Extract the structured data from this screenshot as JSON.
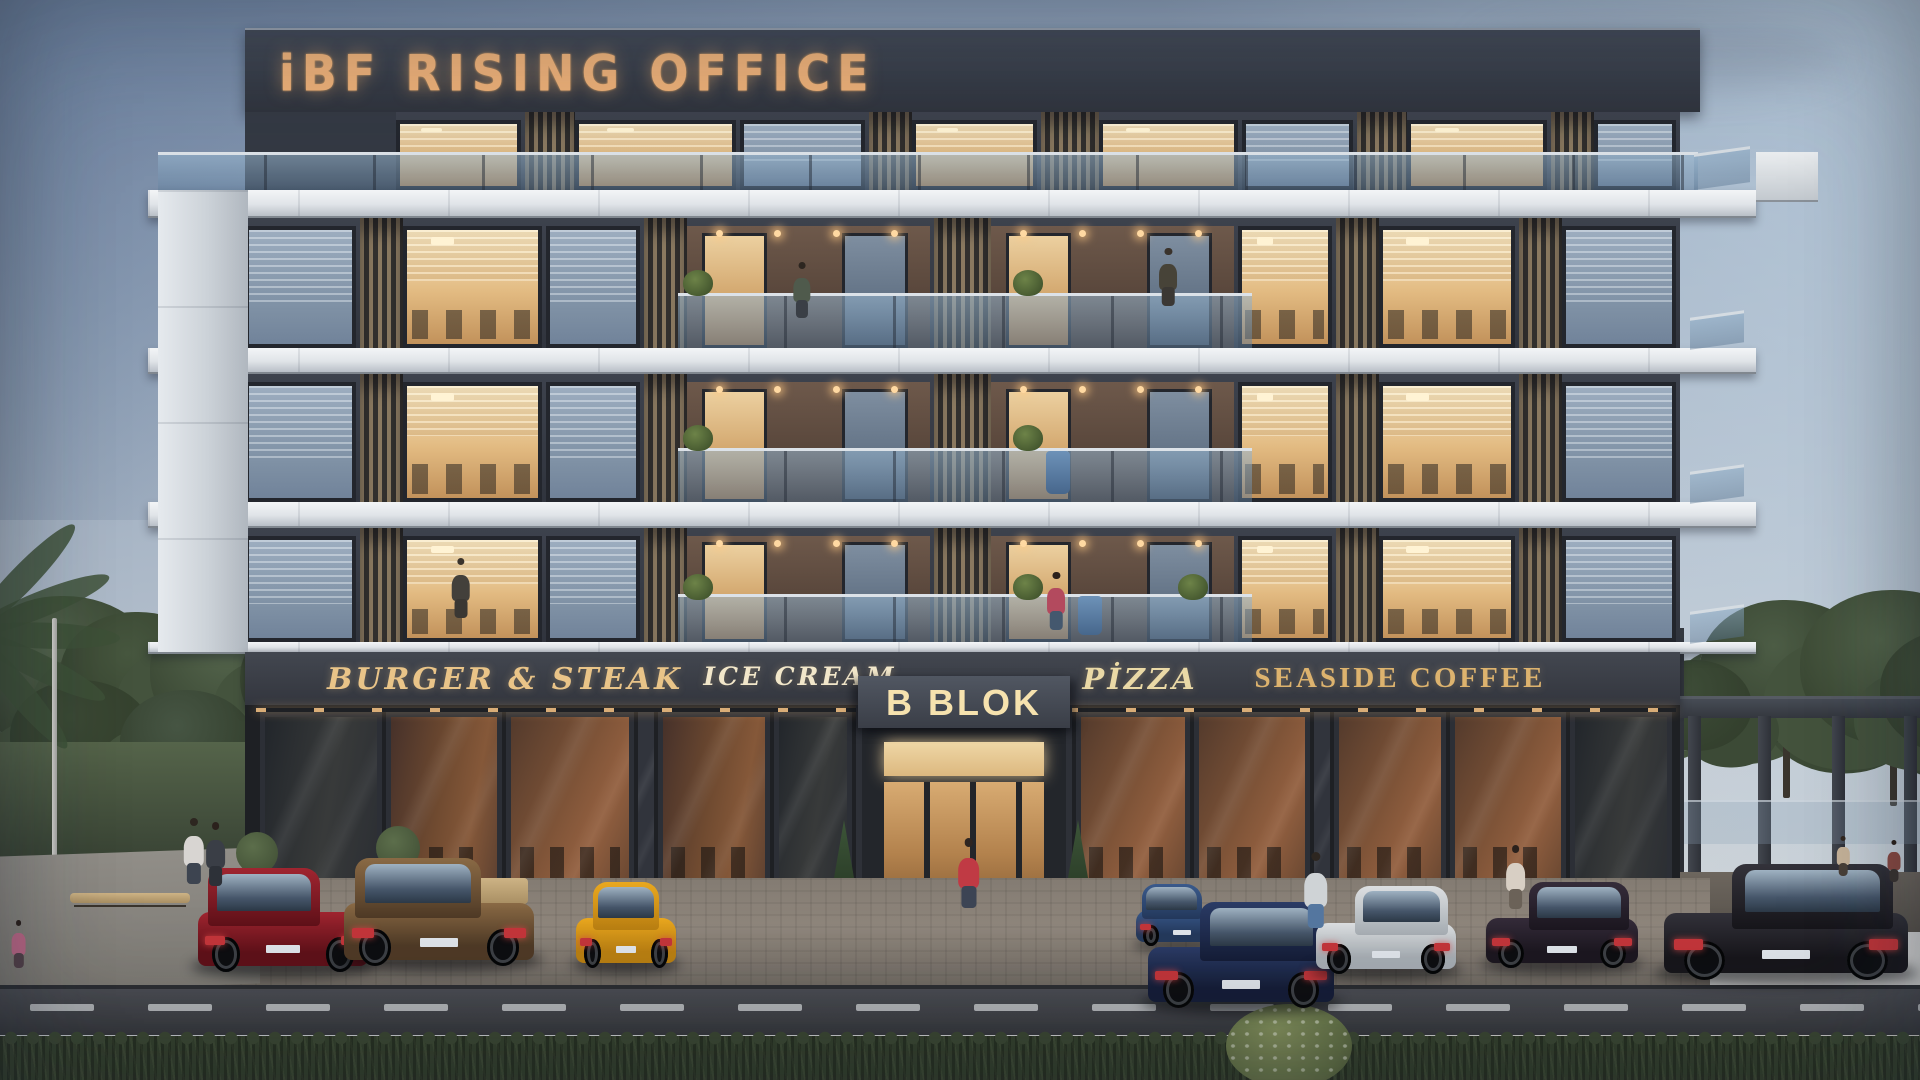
{
  "signs": {
    "rooftop": "iBF RISING OFFICE",
    "entrance_label": "B BLOK",
    "shops": [
      {
        "label": "BURGER & STEAK",
        "x": 505,
        "color": "#e9c488",
        "size": 30,
        "style": "script"
      },
      {
        "label": "ICE CREAM",
        "x": 800,
        "color": "#f2e7ca",
        "size": 25,
        "style": "script"
      },
      {
        "label": "PİZZA",
        "x": 1140,
        "color": "#ead9a6",
        "size": 29,
        "style": "script"
      },
      {
        "label": "SEASIDE COFFEE",
        "x": 1400,
        "color": "#ddb36e",
        "size": 29,
        "style": "serif"
      }
    ]
  },
  "palette": {
    "facade_dark": "#3d424d",
    "band_white": "#e8ecef",
    "sign_gold": "#edb077",
    "window_lit": "#e2ba81",
    "window_dusk": "#8fa3b8",
    "rail_glass": "#9ab6cf",
    "hedge_green": "#36432f",
    "road_gray": "#44464c"
  },
  "building": {
    "floors": [
      {
        "y": 218,
        "h": 130
      },
      {
        "y": 374,
        "h": 128
      },
      {
        "y": 528,
        "h": 114
      }
    ],
    "facade_x": 245,
    "facade_w": 1435,
    "pattern": [
      {
        "t": "dim",
        "x": 0.0,
        "w": 0.08
      },
      {
        "t": "slat",
        "x": 0.08,
        "w": 0.03
      },
      {
        "t": "lit",
        "x": 0.11,
        "w": 0.1,
        "desks": true
      },
      {
        "t": "dim",
        "x": 0.21,
        "w": 0.068
      },
      {
        "t": "slat",
        "x": 0.278,
        "w": 0.03
      },
      {
        "t": "balc",
        "x": 0.308,
        "w": 0.172
      },
      {
        "t": "slat",
        "x": 0.48,
        "w": 0.04
      },
      {
        "t": "balc",
        "x": 0.52,
        "w": 0.172
      },
      {
        "t": "lit",
        "x": 0.692,
        "w": 0.068,
        "desks": true
      },
      {
        "t": "slat",
        "x": 0.76,
        "w": 0.03
      },
      {
        "t": "lit",
        "x": 0.79,
        "w": 0.098,
        "desks": true
      },
      {
        "t": "slat",
        "x": 0.888,
        "w": 0.03
      },
      {
        "t": "dim",
        "x": 0.918,
        "w": 0.082
      }
    ],
    "rails": [
      {
        "x": 0.302,
        "w": 0.4
      }
    ],
    "penthouse": {
      "y": 112,
      "h": 78,
      "x": 245,
      "w": 1435,
      "pattern": [
        {
          "t": "wall",
          "x": 0.0,
          "w": 0.105
        },
        {
          "t": "lit",
          "x": 0.105,
          "w": 0.09
        },
        {
          "t": "slat",
          "x": 0.195,
          "w": 0.035
        },
        {
          "t": "lit",
          "x": 0.23,
          "w": 0.115
        },
        {
          "t": "dim",
          "x": 0.345,
          "w": 0.09
        },
        {
          "t": "slat",
          "x": 0.435,
          "w": 0.03
        },
        {
          "t": "lit",
          "x": 0.465,
          "w": 0.09
        },
        {
          "t": "slat",
          "x": 0.555,
          "w": 0.04
        },
        {
          "t": "lit",
          "x": 0.595,
          "w": 0.1
        },
        {
          "t": "dim",
          "x": 0.695,
          "w": 0.08
        },
        {
          "t": "slat",
          "x": 0.775,
          "w": 0.035
        },
        {
          "t": "lit",
          "x": 0.81,
          "w": 0.1
        },
        {
          "t": "slat",
          "x": 0.91,
          "w": 0.03
        },
        {
          "t": "dim",
          "x": 0.94,
          "w": 0.06
        }
      ]
    },
    "plants": [
      {
        "floor": 0,
        "xf": 0.315
      },
      {
        "floor": 0,
        "xf": 0.545
      },
      {
        "floor": 1,
        "xf": 0.315
      },
      {
        "floor": 1,
        "xf": 0.545
      },
      {
        "floor": 2,
        "xf": 0.315
      },
      {
        "floor": 2,
        "xf": 0.545
      },
      {
        "floor": 2,
        "xf": 0.66
      }
    ],
    "blue_planters": [
      {
        "floor": 1,
        "x": 1046
      },
      {
        "floor": 2,
        "x": 1078
      }
    ],
    "bands": [
      {
        "y": 190,
        "h": 28
      },
      {
        "y": 348,
        "h": 26
      },
      {
        "y": 502,
        "h": 26
      },
      {
        "y": 642,
        "h": 12
      }
    ]
  },
  "storefront": {
    "panels": [
      {
        "x": 260,
        "w": 122,
        "tone": "dark"
      },
      {
        "x": 386,
        "w": 116,
        "tone": "warm"
      },
      {
        "x": 506,
        "w": 128,
        "tone": "warm2"
      },
      {
        "x": 638,
        "w": 16,
        "tone": "col"
      },
      {
        "x": 658,
        "w": 112,
        "tone": "warm"
      },
      {
        "x": 774,
        "w": 78,
        "tone": "dark"
      },
      {
        "x": 1076,
        "w": 114,
        "tone": "warm2"
      },
      {
        "x": 1194,
        "w": 116,
        "tone": "warm2"
      },
      {
        "x": 1314,
        "w": 16,
        "tone": "col"
      },
      {
        "x": 1334,
        "w": 112,
        "tone": "warm2"
      },
      {
        "x": 1450,
        "w": 116,
        "tone": "warm2"
      },
      {
        "x": 1570,
        "w": 102,
        "tone": "dark"
      }
    ]
  },
  "cars": [
    {
      "name": "car-red-sedan",
      "x": 198,
      "y": 868,
      "w": 170,
      "h": 104,
      "c1": "#a02530",
      "c2": "#5f1119",
      "cab": "#241d24",
      "facing": "left"
    },
    {
      "name": "car-bronze-sedan",
      "x": 344,
      "y": 858,
      "w": 190,
      "h": 108,
      "c1": "#8a6a45",
      "c2": "#4f3a26",
      "cab": "#241f1c",
      "facing": "left"
    },
    {
      "name": "car-yellow-mustang",
      "x": 576,
      "y": 882,
      "w": 100,
      "h": 86,
      "c1": "#eaa81f",
      "c2": "#b97f12",
      "cab": "#1e1c1a",
      "facing": "rear"
    },
    {
      "name": "car-blue-coupe",
      "x": 1136,
      "y": 884,
      "w": 92,
      "h": 62,
      "c1": "#3a5a8c",
      "c2": "#24395c",
      "cab": "#1a2230",
      "facing": "left"
    },
    {
      "name": "car-navy-golf",
      "x": 1148,
      "y": 902,
      "w": 186,
      "h": 106,
      "c1": "#2b3c66",
      "c2": "#151d38",
      "cab": "#10141f",
      "facing": "right"
    },
    {
      "name": "car-white-wagon",
      "x": 1316,
      "y": 886,
      "w": 140,
      "h": 88,
      "c1": "#dcdfe1",
      "c2": "#a6adb3",
      "cab": "#3a434e",
      "facing": "right"
    },
    {
      "name": "car-dark-sedan",
      "x": 1486,
      "y": 882,
      "w": 152,
      "h": 86,
      "c1": "#352c3a",
      "c2": "#1c1720",
      "cab": "#151019",
      "facing": "right"
    },
    {
      "name": "car-black-sedan",
      "x": 1664,
      "y": 864,
      "w": 244,
      "h": 116,
      "c1": "#33323a",
      "c2": "#17161b",
      "cab": "#0f0f13",
      "facing": "right"
    }
  ],
  "people": [
    {
      "name": "person-balcony-man",
      "x": 792,
      "y": 262,
      "h": 56,
      "head": "#2d2620",
      "body": "#4f5a4c",
      "legs": "#3a3f46"
    },
    {
      "name": "person-balcony-woman",
      "x": 1046,
      "y": 572,
      "h": 58,
      "head": "#2b211c",
      "body": "#b34a5e",
      "legs": "#44586e"
    },
    {
      "name": "person-office-figure-1",
      "x": 450,
      "y": 558,
      "h": 60,
      "head": "#3a332c",
      "body": "#43403b",
      "legs": "#3a3733"
    },
    {
      "name": "person-office-figure-2",
      "x": 1158,
      "y": 248,
      "h": 58,
      "head": "#3a332c",
      "body": "#474338",
      "legs": "#3b3834"
    },
    {
      "name": "person-walker-1",
      "x": 182,
      "y": 818,
      "h": 66,
      "head": "#2d2620",
      "body": "#d8d5d2",
      "legs": "#3d4450"
    },
    {
      "name": "person-walker-2",
      "x": 204,
      "y": 822,
      "h": 64,
      "head": "#2b211c",
      "body": "#3a3e46",
      "legs": "#2d3138"
    },
    {
      "name": "person-walker-pink",
      "x": 10,
      "y": 920,
      "h": 48,
      "head": "#2b211c",
      "body": "#c06a8a",
      "legs": "#55424a"
    },
    {
      "name": "person-sidewalk-man",
      "x": 1302,
      "y": 852,
      "h": 76,
      "head": "#2d2620",
      "body": "#cfd3d6",
      "legs": "#5577a0"
    },
    {
      "name": "person-sidewalk-woman",
      "x": 1504,
      "y": 845,
      "h": 64,
      "head": "#2b211c",
      "body": "#d8cfc4",
      "legs": "#6b6258"
    },
    {
      "name": "person-terrace-1",
      "x": 1836,
      "y": 836,
      "h": 40,
      "head": "#33291f",
      "body": "#c8b49a",
      "legs": "#4a4038"
    },
    {
      "name": "person-terrace-2",
      "x": 1886,
      "y": 840,
      "h": 42,
      "head": "#2b211c",
      "body": "#8a4a42",
      "legs": "#3a3330"
    }
  ],
  "entrance_person": {
    "name": "person-entrance-woman",
    "x": 956,
    "y": 838,
    "h": 70,
    "head": "#2e2521",
    "body": "#c03a44",
    "legs": "#3c4454"
  },
  "trees": {
    "left": [
      {
        "x": -30,
        "y": 596,
        "r": 120,
        "c": "#53644c"
      },
      {
        "x": 60,
        "y": 612,
        "r": 100,
        "c": "#47573f"
      },
      {
        "x": 150,
        "y": 598,
        "r": 115,
        "c": "#55664d"
      },
      {
        "x": 240,
        "y": 618,
        "r": 95,
        "c": "#49593f"
      },
      {
        "x": 300,
        "y": 640,
        "r": 80,
        "c": "#3f4f38"
      },
      {
        "x": 10,
        "y": 680,
        "r": 90,
        "c": "#3c4a35"
      },
      {
        "x": 120,
        "y": 690,
        "r": 85,
        "c": "#465543"
      }
    ],
    "right": [
      {
        "x": 1700,
        "y": 600,
        "r": 110,
        "c": "#4c5c45"
      },
      {
        "x": 1800,
        "y": 590,
        "r": 120,
        "c": "#53644a"
      },
      {
        "x": 1880,
        "y": 630,
        "r": 95,
        "c": "#44533c"
      },
      {
        "x": 1640,
        "y": 660,
        "r": 70,
        "c": "#3d4c37"
      },
      {
        "x": 1440,
        "y": 608,
        "r": 60,
        "c": "#475541"
      }
    ],
    "palm_fronds": 5
  },
  "pergola": {
    "columns": [
      1688,
      1758,
      1832,
      1904
    ]
  },
  "road": {
    "dash_y": 1004,
    "dash_w": 64,
    "dash_gap": 54,
    "dash_start": 30
  }
}
